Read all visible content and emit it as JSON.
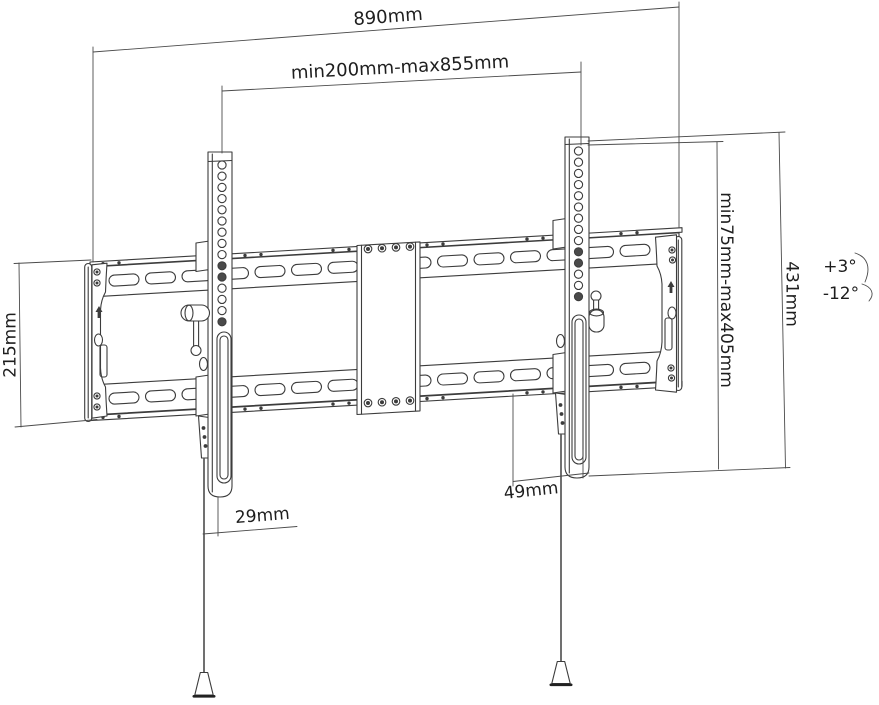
{
  "drawing": {
    "labels": {
      "overall_width": "890mm",
      "vesa_width_range": "min200mm-max855mm",
      "wall_plate_height": "215mm",
      "vesa_height_range": "min75mm-max405mm",
      "bracket_height": "431mm",
      "bracket_bottom_offset": "49mm",
      "arm_bottom_depth": "29mm"
    },
    "tilt": {
      "up": "+3°",
      "down": "-12°"
    },
    "colors": {
      "background": "#ffffff",
      "line": "#3c3c3c",
      "dimension_line": "#4b4b4b",
      "text": "#1e1e1e"
    }
  }
}
